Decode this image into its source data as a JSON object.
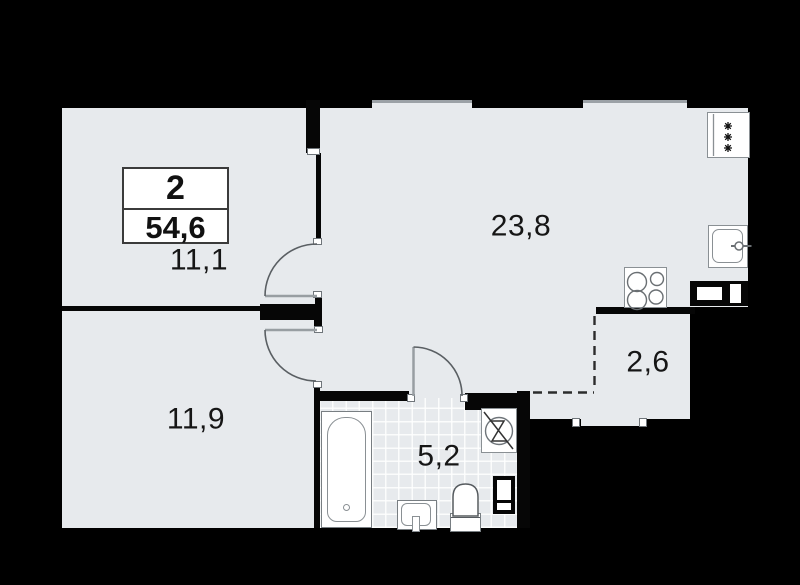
{
  "plan": {
    "title": "apartment-floor-plan",
    "unit": {
      "rooms_count": "2",
      "total_area": "54,6"
    },
    "rooms": {
      "bedroom1": {
        "area": "11,1"
      },
      "living_kitchen": {
        "area": "23,8"
      },
      "balcony": {
        "area": "2,6"
      },
      "bedroom2": {
        "area": "11,9"
      },
      "bathroom": {
        "area": "5,2"
      }
    },
    "fixtures": [
      "bathtub",
      "washbasin",
      "toilet",
      "washing-machine",
      "duct-shaft",
      "kitchen-stove",
      "kitchen-sink",
      "fridge",
      "vent-box"
    ],
    "icons": {
      "fridge-frost-icon": "✱✱✱",
      "washing-machine-icon": "circle-with-zigzag",
      "door-swing-icon": "quarter-arc"
    },
    "colors": {
      "background": "#000000",
      "floor": "#e7eaed",
      "wall": "#060606",
      "fixture_fill": "#ffffff",
      "window_line": "#9ba1a6"
    }
  }
}
